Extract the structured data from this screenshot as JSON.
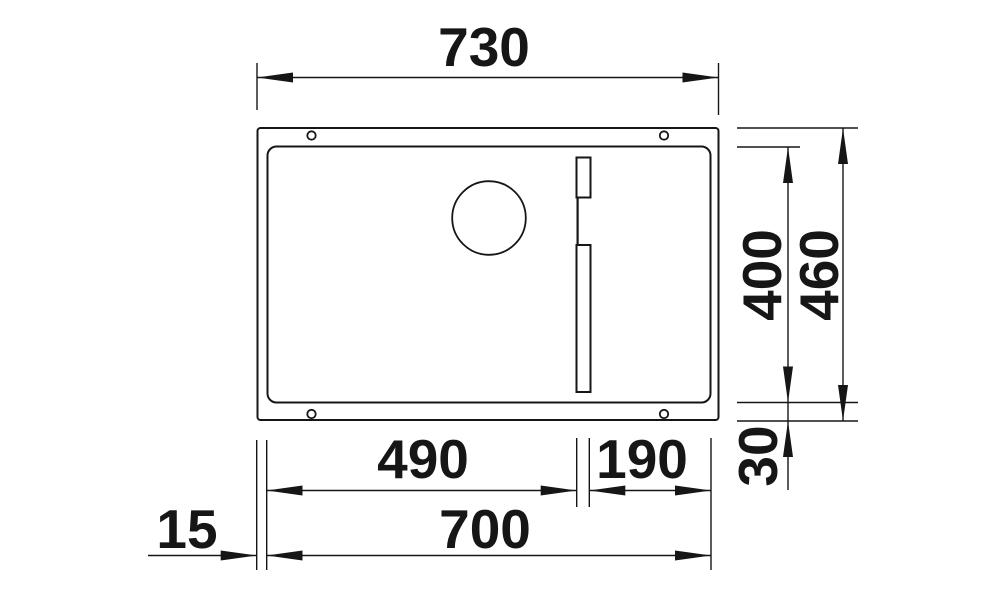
{
  "drawing": {
    "name": "undermount sink technical dimension drawing",
    "view": "top-view",
    "units": "mm",
    "colors": {
      "ink": "#161616",
      "background": "#ffffff"
    },
    "dims": {
      "overall_width": "730",
      "overall_depth": "460",
      "bowl_depth": "400",
      "bowl_section_left": "490",
      "bowl_section_right": "190",
      "bowl_width": "700",
      "rim_offset_left": "15",
      "rim_offset_bottom": "30"
    }
  }
}
